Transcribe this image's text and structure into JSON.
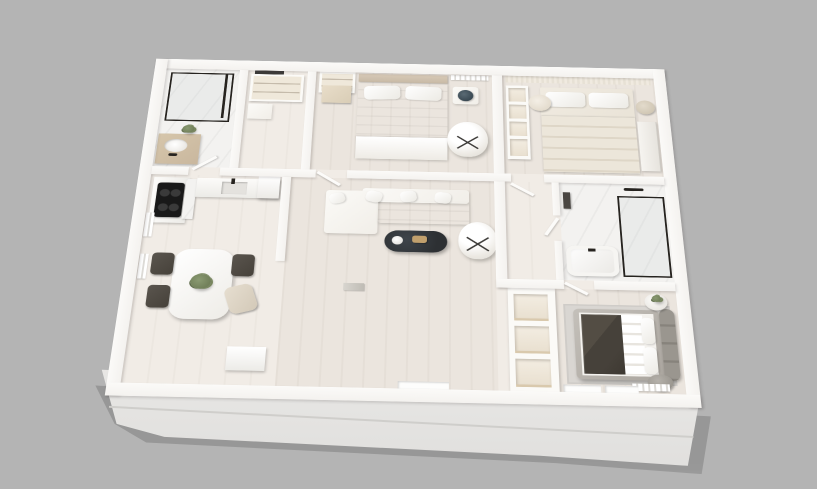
{
  "scene": {
    "title": "3D rendered apartment floor plan",
    "style": "isometric perspective render, white walls, gray backdrop",
    "background": "#b4b4b4"
  },
  "palette": {
    "bg": "#b4b4b4",
    "wall": "#f4f2ef",
    "wall-shade": "#dedcd8",
    "floor-wood": "#ebe5de",
    "floor-wood-light": "#f1ece6",
    "floor-marble": "#f3f2f0",
    "fabric-white": "#f1eee8",
    "fabric-cream": "#e6dfd2",
    "charcoal": "#46413a",
    "frame-black": "#26231f",
    "wood": "#c9b79e",
    "gray-upholstery": "#8f8b85",
    "rug-gray": "#d9d6d2",
    "table-dark": "#2d3033",
    "gold": "#c1a06d",
    "green": "#66744f"
  },
  "rooms": [
    {
      "id": "bathroom-1",
      "name": "Bathroom (top-left)",
      "floor": "marble",
      "furniture": [
        "walk-in glass shower with black frame",
        "wood-top vanity with white basin",
        "black faucet",
        "potted plant"
      ]
    },
    {
      "id": "entry-closet",
      "name": "Entry closet / laundry",
      "floor": "wood-light",
      "furniture": [
        "open wardrobe with shelves",
        "low cabinet",
        "dark wall mirror"
      ]
    },
    {
      "id": "bedroom-1",
      "name": "Bedroom 1",
      "floor": "wood",
      "furniture": [
        "double bed with white bedding",
        "two pillows",
        "tan headboard",
        "open shelf unit",
        "wood bench",
        "round side table with dark decor",
        "white swivel armchair",
        "radiator"
      ]
    },
    {
      "id": "bedroom-2",
      "name": "Bedroom 2",
      "floor": "wood",
      "furniture": [
        "double bed with cream layered duvet",
        "two pillows",
        "striped curtain wall",
        "white shelf unit",
        "round side table",
        "beige stool",
        "built-in wardrobe"
      ]
    },
    {
      "id": "hallway",
      "name": "Hallway",
      "floor": "wood-light",
      "furniture": [
        "open interior doors"
      ]
    },
    {
      "id": "bathroom-2",
      "name": "Bathroom 2",
      "floor": "marble",
      "furniture": [
        "white bathtub with black spout",
        "glass shower with black frame",
        "black towel rail",
        "dark hanging towels"
      ]
    },
    {
      "id": "storage-shelving",
      "name": "Storage shelving column",
      "floor": "none",
      "furniture": [
        "three open cubbies with wood shelves"
      ]
    },
    {
      "id": "bedroom-3",
      "name": "Bedroom 3 (bottom-right)",
      "floor": "wood",
      "furniture": [
        "bed with charcoal duvet and white throw",
        "gray upholstered cushion headboard",
        "gray pouf",
        "round side table with plant",
        "light gray rug",
        "radiator",
        "two window sills"
      ]
    },
    {
      "id": "living-room",
      "name": "Living room",
      "floor": "wood",
      "furniture": [
        "white corner sofa with pillows",
        "dark oval coffee table",
        "gold tray",
        "white bowl",
        "white swivel armchair",
        "magazines on floor",
        "window recess"
      ]
    },
    {
      "id": "kitchen-dining",
      "name": "Kitchen & dining",
      "floor": "wood-light",
      "furniture": [
        "L-shaped white counter",
        "black cooktop",
        "inset sink with black faucet",
        "marble backsplash",
        "tall cabinet",
        "white dining table",
        "two dark chairs",
        "dark chair",
        "light fabric chair",
        "table plant",
        "white credenza",
        "two radiators"
      ]
    }
  ]
}
